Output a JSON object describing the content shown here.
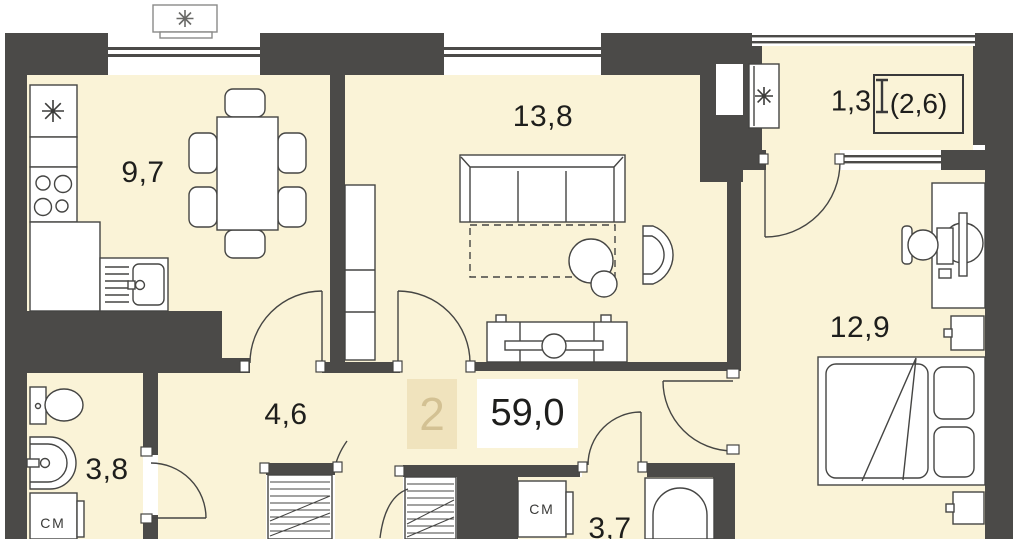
{
  "floorplan": {
    "unit": {
      "rooms_count": "2",
      "total_area": "59,0"
    },
    "rooms": [
      {
        "id": "kitchen",
        "area": "9,7"
      },
      {
        "id": "living-room",
        "area": "13,8"
      },
      {
        "id": "hallway",
        "area": "4,6"
      },
      {
        "id": "bathroom",
        "area": "3,8"
      },
      {
        "id": "bathroom-2",
        "area": "3,7"
      },
      {
        "id": "bedroom",
        "area": "12,9"
      },
      {
        "id": "balcony",
        "area": "1,3",
        "area_unreduced": "(2,6)"
      }
    ],
    "labels": {
      "washer": "СМ"
    },
    "icons": {
      "fridge": "snowflake-icon",
      "ac_outdoor_unit": "snowflake-icon",
      "ac_balcony_unit": "snowflake-icon",
      "balcony_dimension": "height-bracket-icon"
    },
    "colors": {
      "wall": "#4b4a48",
      "floor": "#faf3d7",
      "furniture_line": "#454543",
      "text": "#1e1e1c",
      "rooms_badge_bg": "#f0e3bd",
      "rooms_badge_text": "#d3c193"
    }
  }
}
